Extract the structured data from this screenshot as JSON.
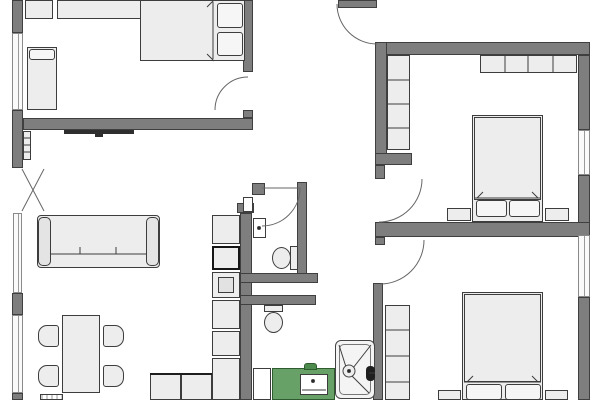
{
  "plan": {
    "title": "apartment-floor-plan",
    "canvas": {
      "w": 600,
      "h": 400,
      "bg": "#ffffff"
    },
    "colors": {
      "wall": "#7e7e7e",
      "wall_border": "#3f3f3f",
      "furniture": "#ededed",
      "furniture_border": "#3d3d3d",
      "window": "#fafafa",
      "window_border": "#8a8a8a",
      "dark": "#2e2e2e",
      "green": "#68a168",
      "green_border": "#2f5c2f",
      "door_arc": "#666666",
      "detail_line": "#3d3d3d"
    },
    "walls": [
      {
        "name": "left-wall-a",
        "x": 12,
        "y": 0,
        "w": 11,
        "h": 33
      },
      {
        "name": "left-wall-b",
        "x": 12,
        "y": 110,
        "w": 11,
        "h": 58
      },
      {
        "name": "left-wall-c",
        "x": 12,
        "y": 293,
        "w": 11,
        "h": 22
      },
      {
        "name": "left-wall-d",
        "x": 12,
        "y": 393,
        "w": 11,
        "h": 7
      },
      {
        "name": "bedroom1-south-wall",
        "x": 23,
        "y": 118,
        "w": 230,
        "h": 12
      },
      {
        "name": "bedroom1-east-wall",
        "x": 243,
        "y": 0,
        "w": 10,
        "h": 72
      },
      {
        "name": "bedroom1-east-jamb",
        "x": 243,
        "y": 110,
        "w": 10,
        "h": 8
      },
      {
        "name": "top-door-stub-wall",
        "x": 338,
        "y": 0,
        "w": 39,
        "h": 8
      },
      {
        "name": "right-section-north-wall",
        "x": 375,
        "y": 42,
        "w": 215,
        "h": 13
      },
      {
        "name": "bedroom2-west-wall",
        "x": 375,
        "y": 42,
        "w": 12,
        "h": 121
      },
      {
        "name": "bedroom2-sw-stub-wall",
        "x": 375,
        "y": 153,
        "w": 37,
        "h": 12
      },
      {
        "name": "bedroom2-door-jamb",
        "x": 375,
        "y": 165,
        "w": 10,
        "h": 14
      },
      {
        "name": "right-outer-wall-a",
        "x": 578,
        "y": 55,
        "w": 12,
        "h": 75
      },
      {
        "name": "right-outer-wall-b",
        "x": 578,
        "y": 175,
        "w": 12,
        "h": 60
      },
      {
        "name": "right-outer-wall-c",
        "x": 578,
        "y": 297,
        "w": 12,
        "h": 103
      },
      {
        "name": "middle-horizontal-wall",
        "x": 375,
        "y": 222,
        "w": 215,
        "h": 15
      },
      {
        "name": "bedroom3-door-jamb",
        "x": 375,
        "y": 237,
        "w": 10,
        "h": 8
      },
      {
        "name": "kitchen-tall-wall",
        "x": 240,
        "y": 213,
        "w": 12,
        "h": 187
      },
      {
        "name": "kitchen-wall-cap",
        "x": 237,
        "y": 203,
        "w": 17,
        "h": 10
      },
      {
        "name": "wc-east-wall",
        "x": 297,
        "y": 182,
        "w": 10,
        "h": 101
      },
      {
        "name": "wc-north-jamb",
        "x": 252,
        "y": 183,
        "w": 13,
        "h": 12
      },
      {
        "name": "shaft-wall-a",
        "x": 240,
        "y": 273,
        "w": 78,
        "h": 10
      },
      {
        "name": "shaft-wall-b",
        "x": 240,
        "y": 295,
        "w": 76,
        "h": 10
      },
      {
        "name": "bathroom-east-wall",
        "x": 373,
        "y": 283,
        "w": 10,
        "h": 117
      }
    ],
    "windows": [
      {
        "name": "left-window-1",
        "x": 12,
        "y": 33,
        "w": 11,
        "h": 77
      },
      {
        "name": "left-window-2",
        "x": 13,
        "y": 213,
        "w": 9,
        "h": 80
      },
      {
        "name": "left-window-3",
        "x": 12,
        "y": 315,
        "w": 11,
        "h": 78
      },
      {
        "name": "right-window-1",
        "x": 578,
        "y": 130,
        "w": 12,
        "h": 45
      },
      {
        "name": "right-window-2",
        "x": 578,
        "y": 235,
        "w": 12,
        "h": 62
      }
    ],
    "furniture": [
      {
        "name": "dresser-a",
        "x": 25,
        "y": 0,
        "w": 28,
        "h": 19,
        "kind": "std"
      },
      {
        "name": "dresser-b",
        "x": 57,
        "y": 0,
        "w": 96,
        "h": 19,
        "kind": "std"
      },
      {
        "name": "single-bed",
        "x": 27,
        "y": 47,
        "w": 30,
        "h": 63,
        "kind": "std"
      },
      {
        "name": "single-bed-pillow",
        "x": 29,
        "y": 49,
        "w": 26,
        "h": 11,
        "kind": "pillow"
      },
      {
        "name": "double-bed",
        "x": 140,
        "y": 0,
        "w": 105,
        "h": 61,
        "kind": "std"
      },
      {
        "name": "double-bed-pillow-a",
        "x": 217,
        "y": 3,
        "w": 26,
        "h": 25,
        "kind": "pillow"
      },
      {
        "name": "double-bed-pillow-b",
        "x": 217,
        "y": 32,
        "w": 26,
        "h": 24,
        "kind": "pillow"
      },
      {
        "name": "tv",
        "x": 64,
        "y": 130,
        "w": 70,
        "h": 4,
        "kind": "dark"
      },
      {
        "name": "tv-mount",
        "x": 95,
        "y": 134,
        "w": 8,
        "h": 3,
        "kind": "dark"
      },
      {
        "name": "wall-shelf",
        "x": 23,
        "y": 131,
        "w": 8,
        "h": 29,
        "kind": "std"
      },
      {
        "name": "sofa",
        "x": 37,
        "y": 215,
        "w": 123,
        "h": 53,
        "kind": "sofa"
      },
      {
        "name": "sofa-arm-left",
        "x": 38,
        "y": 217,
        "w": 13,
        "h": 49,
        "kind": "sofa-arm"
      },
      {
        "name": "sofa-arm-right",
        "x": 146,
        "y": 217,
        "w": 13,
        "h": 49,
        "kind": "sofa-arm"
      },
      {
        "name": "dining-table",
        "x": 62,
        "y": 315,
        "w": 38,
        "h": 78,
        "kind": "std"
      },
      {
        "name": "chair",
        "x": 38,
        "y": 325,
        "w": 21,
        "h": 22,
        "kind": "chair-left"
      },
      {
        "name": "chair",
        "x": 38,
        "y": 365,
        "w": 21,
        "h": 22,
        "kind": "chair-left"
      },
      {
        "name": "chair",
        "x": 103,
        "y": 325,
        "w": 21,
        "h": 22,
        "kind": "chair-right"
      },
      {
        "name": "chair",
        "x": 103,
        "y": 365,
        "w": 21,
        "h": 22,
        "kind": "chair-right"
      },
      {
        "name": "floor-vent",
        "x": 40,
        "y": 394,
        "w": 23,
        "h": 6,
        "kind": "vent"
      },
      {
        "name": "kitchen-counter",
        "x": 150,
        "y": 373,
        "w": 31,
        "h": 27,
        "kind": "counter"
      },
      {
        "name": "kitchen-counter",
        "x": 181,
        "y": 373,
        "w": 31,
        "h": 27,
        "kind": "counter"
      },
      {
        "name": "tall-cabinet",
        "x": 212,
        "y": 215,
        "w": 28,
        "h": 29,
        "kind": "std"
      },
      {
        "name": "fridge",
        "x": 212,
        "y": 246,
        "w": 28,
        "h": 24,
        "kind": "fridge"
      },
      {
        "name": "oven",
        "x": 212,
        "y": 272,
        "w": 28,
        "h": 26,
        "kind": "std"
      },
      {
        "name": "oven-inner",
        "x": 218,
        "y": 277,
        "w": 16,
        "h": 16,
        "kind": "oven-inner"
      },
      {
        "name": "tall-cabinet",
        "x": 212,
        "y": 300,
        "w": 28,
        "h": 29,
        "kind": "std"
      },
      {
        "name": "tall-cabinet",
        "x": 212,
        "y": 331,
        "w": 28,
        "h": 25,
        "kind": "std"
      },
      {
        "name": "tall-cabinet",
        "x": 212,
        "y": 358,
        "w": 28,
        "h": 42,
        "kind": "std"
      },
      {
        "name": "wall-niche",
        "x": 243,
        "y": 197,
        "w": 10,
        "h": 15,
        "kind": "white"
      },
      {
        "name": "wc-washbasin",
        "x": 253,
        "y": 218,
        "w": 13,
        "h": 20,
        "kind": "white"
      },
      {
        "name": "wc-toilet-tank",
        "x": 290,
        "y": 246,
        "w": 8,
        "h": 24,
        "kind": "std"
      },
      {
        "name": "wc-toilet-bowl",
        "x": 272,
        "y": 247,
        "w": 19,
        "h": 22,
        "kind": "ellipse"
      },
      {
        "name": "bath-toilet-tank",
        "x": 264,
        "y": 305,
        "w": 19,
        "h": 7,
        "kind": "std"
      },
      {
        "name": "bath-toilet-bowl",
        "x": 264,
        "y": 312,
        "w": 19,
        "h": 21,
        "kind": "ellipse"
      },
      {
        "name": "washing-machine",
        "x": 253,
        "y": 368,
        "w": 18,
        "h": 32,
        "kind": "white"
      },
      {
        "name": "vanity-counter",
        "x": 272,
        "y": 368,
        "w": 63,
        "h": 32,
        "kind": "green"
      },
      {
        "name": "vanity-nub",
        "x": 304,
        "y": 363,
        "w": 13,
        "h": 7,
        "kind": "green-dark"
      },
      {
        "name": "bathroom-sink",
        "x": 300,
        "y": 374,
        "w": 28,
        "h": 21,
        "kind": "white"
      },
      {
        "name": "shower-tray",
        "x": 335,
        "y": 340,
        "w": 40,
        "h": 59,
        "kind": "tray"
      },
      {
        "name": "shower-tray-inner",
        "x": 339,
        "y": 344,
        "w": 32,
        "h": 51,
        "kind": "tray-inner"
      },
      {
        "name": "shower-head",
        "x": 366,
        "y": 366,
        "w": 9,
        "h": 15,
        "kind": "dark-round"
      },
      {
        "name": "wardrobe",
        "x": 387,
        "y": 55,
        "w": 23,
        "h": 95,
        "kind": "std"
      },
      {
        "name": "wardrobe",
        "x": 480,
        "y": 55,
        "w": 97,
        "h": 18,
        "kind": "std"
      },
      {
        "name": "bed-frame",
        "x": 472,
        "y": 115,
        "w": 71,
        "h": 107,
        "kind": "std"
      },
      {
        "name": "mattress",
        "x": 474,
        "y": 117,
        "w": 67,
        "h": 83,
        "kind": "std"
      },
      {
        "name": "pillow",
        "x": 476,
        "y": 200,
        "w": 31,
        "h": 17,
        "kind": "pillow"
      },
      {
        "name": "pillow",
        "x": 509,
        "y": 200,
        "w": 31,
        "h": 17,
        "kind": "pillow"
      },
      {
        "name": "nightstand",
        "x": 447,
        "y": 208,
        "w": 24,
        "h": 13,
        "kind": "std"
      },
      {
        "name": "nightstand",
        "x": 545,
        "y": 208,
        "w": 24,
        "h": 13,
        "kind": "std"
      },
      {
        "name": "wardrobe",
        "x": 385,
        "y": 305,
        "w": 25,
        "h": 95,
        "kind": "std"
      },
      {
        "name": "bed-frame",
        "x": 462,
        "y": 292,
        "w": 81,
        "h": 108,
        "kind": "std"
      },
      {
        "name": "mattress",
        "x": 464,
        "y": 294,
        "w": 77,
        "h": 88,
        "kind": "std"
      },
      {
        "name": "pillow",
        "x": 466,
        "y": 384,
        "w": 36,
        "h": 16,
        "kind": "pillow"
      },
      {
        "name": "pillow",
        "x": 505,
        "y": 384,
        "w": 36,
        "h": 16,
        "kind": "pillow"
      },
      {
        "name": "nightstand",
        "x": 438,
        "y": 390,
        "w": 23,
        "h": 10,
        "kind": "std"
      },
      {
        "name": "nightstand",
        "x": 545,
        "y": 390,
        "w": 23,
        "h": 10,
        "kind": "std"
      }
    ],
    "doors": [
      {
        "name": "bedroom1-door-arc",
        "path": "M215,110 A33,33 0 0 1 248,77"
      },
      {
        "name": "hall-top-door-arc",
        "path": "M337,4 A40,40 0 0 0 377,44"
      },
      {
        "name": "wc-door-leaf",
        "path": "M262,188 L300,188"
      },
      {
        "name": "wc-door-arc",
        "path": "M300,188 A38,38 0 0 1 262,226"
      },
      {
        "name": "bedroom2-door-arc",
        "path": "M422,179 A43,43 0 0 1 379,222"
      },
      {
        "name": "bedroom3-door-arc",
        "path": "M424,240 A44,44 0 0 1 380,284"
      },
      {
        "name": "entrance-door-leaf-a",
        "path": "M22,169 L44,211"
      },
      {
        "name": "entrance-door-leaf-b",
        "path": "M22,211 L44,169"
      }
    ],
    "details": [
      {
        "name": "wardrobe-divider",
        "path": "M387,80 L410,80"
      },
      {
        "name": "wardrobe-divider",
        "path": "M387,104 L410,104"
      },
      {
        "name": "wardrobe-divider",
        "path": "M387,128 L410,128"
      },
      {
        "name": "wardrobe-divider",
        "path": "M505,55 L505,73"
      },
      {
        "name": "wardrobe-divider",
        "path": "M528,55 L528,73"
      },
      {
        "name": "wardrobe-divider",
        "path": "M553,55 L553,73"
      },
      {
        "name": "wardrobe-divider",
        "path": "M385,330 L410,330"
      },
      {
        "name": "wardrobe-divider",
        "path": "M385,356 L410,356"
      },
      {
        "name": "wardrobe-divider",
        "path": "M385,382 L410,382"
      },
      {
        "name": "shelf-divider",
        "path": "M23,138 L31,138"
      },
      {
        "name": "shelf-divider",
        "path": "M23,145 L31,145"
      },
      {
        "name": "shelf-divider",
        "path": "M23,152 L31,152"
      },
      {
        "name": "sofa-seat-line",
        "path": "M50,254 L146,254"
      },
      {
        "name": "sofa-cushion-tick",
        "path": "M80,247 L80,254"
      },
      {
        "name": "sofa-cushion-tick",
        "path": "M116,247 L116,254"
      },
      {
        "name": "bed-frame-line",
        "path": "M474,198 L541,198"
      },
      {
        "name": "bed-frame-line",
        "path": "M464,382 L541,382"
      },
      {
        "name": "bed-frame-line",
        "path": "M213,2 L213,59"
      },
      {
        "name": "sink-line",
        "path": "M302,390 L326,390"
      },
      {
        "name": "shower-diagonal",
        "path": "M339,345 L346,367"
      },
      {
        "name": "shower-diagonal",
        "path": "M371,345 L353,368"
      },
      {
        "name": "shower-diagonal",
        "path": "M351,375 L369,393"
      },
      {
        "name": "shower-arm",
        "path": "M375,373 L369,373"
      },
      {
        "name": "mattress-fold",
        "path": "M207,7 L214,0"
      },
      {
        "name": "mattress-fold",
        "path": "M207,54 L214,61"
      },
      {
        "name": "mattress-fold",
        "path": "M477,198 L483,192"
      },
      {
        "name": "mattress-fold",
        "path": "M538,198 L532,192"
      },
      {
        "name": "mattress-fold",
        "path": "M467,382 L473,376"
      },
      {
        "name": "mattress-fold",
        "path": "M538,382 L532,376"
      },
      {
        "name": "counter-edge-bold",
        "path": "M150,374 L212,374",
        "bold": true
      }
    ],
    "circles": [
      {
        "name": "sink-faucet-dot",
        "cx": 313,
        "cy": 381,
        "r": 1.5,
        "fill": true
      },
      {
        "name": "washbasin-dot",
        "cx": 259,
        "cy": 228,
        "r": 1.5,
        "fill": true
      },
      {
        "name": "shower-drain",
        "cx": 349,
        "cy": 371,
        "r": 6,
        "fill": false
      },
      {
        "name": "shower-drain-dot",
        "cx": 349,
        "cy": 371,
        "r": 1.5,
        "fill": true
      }
    ]
  }
}
